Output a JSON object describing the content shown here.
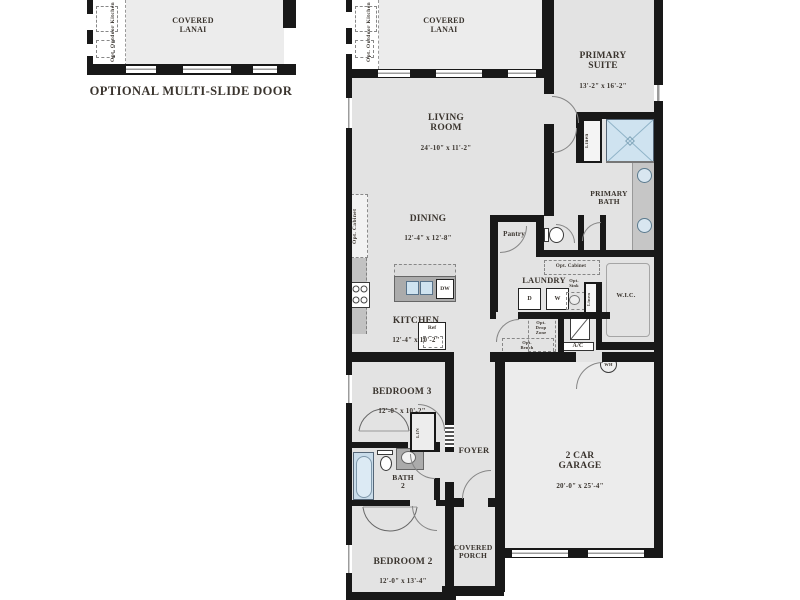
{
  "colors": {
    "wall": "#181818",
    "room_fill": "#e3e3e3",
    "lanai_fill": "#ececec",
    "fixture_blue": "#cfe3f0",
    "counter_gray": "#b9b9b9",
    "text": "#3a342e"
  },
  "inset": {
    "lanai_name": "COVERED\nLANAI",
    "outdoor_kitchen_label": "Opt. Outdoor Kitchen",
    "caption": "OPTIONAL MULTI-SLIDE DOOR"
  },
  "rooms": {
    "covered_lanai": {
      "name": "COVERED\nLANAI"
    },
    "outdoor_kitchen_label": "Opt. Outdoor Kitchen",
    "primary_suite": {
      "name": "PRIMARY\nSUITE",
      "dims": "13'-2\" x 16'-2\""
    },
    "living_room": {
      "name": "LIVING\nROOM",
      "dims": "24'-10\" x 11'-2\""
    },
    "dining": {
      "name": "DINING",
      "dims": "12'-4\" x 12'-8\""
    },
    "kitchen": {
      "name": "KITCHEN",
      "dims": "12'-4\" x 10'-2\""
    },
    "primary_bath": {
      "name": "PRIMARY\nBATH"
    },
    "pantry": {
      "name": "Pantry"
    },
    "laundry": {
      "name": "LAUNDRY"
    },
    "wic": {
      "name": "W.I.C."
    },
    "bedroom3": {
      "name": "BEDROOM 3",
      "dims": "12'-0\" x 10'-2\""
    },
    "bath2": {
      "name": "BATH\n2"
    },
    "foyer": {
      "name": "FOYER"
    },
    "bedroom2": {
      "name": "BEDROOM 2",
      "dims": "12'-0\" x 13'-4\""
    },
    "covered_porch": {
      "name": "COVERED\nPORCH"
    },
    "garage": {
      "name": "2 CAR\nGARAGE",
      "dims": "20'-0\" x 25'-4\""
    }
  },
  "fixtures": {
    "linen_bath": "Linen",
    "linen_hall": "Linen",
    "lin_closet": "LIN",
    "opt_cabinet_dining": "Opt. Cabinet",
    "opt_cabinet_laundry": "Opt. Cabinet",
    "opt_sink": "Opt.\nSink",
    "opt_drop_zone": "Opt.\nDrop\nZone",
    "opt_bench": "Opt.\nBench",
    "ac": "A/C",
    "wh": "WH",
    "dryer": "D",
    "washer": "W",
    "dishwasher": "DW",
    "ref": "Ref"
  }
}
